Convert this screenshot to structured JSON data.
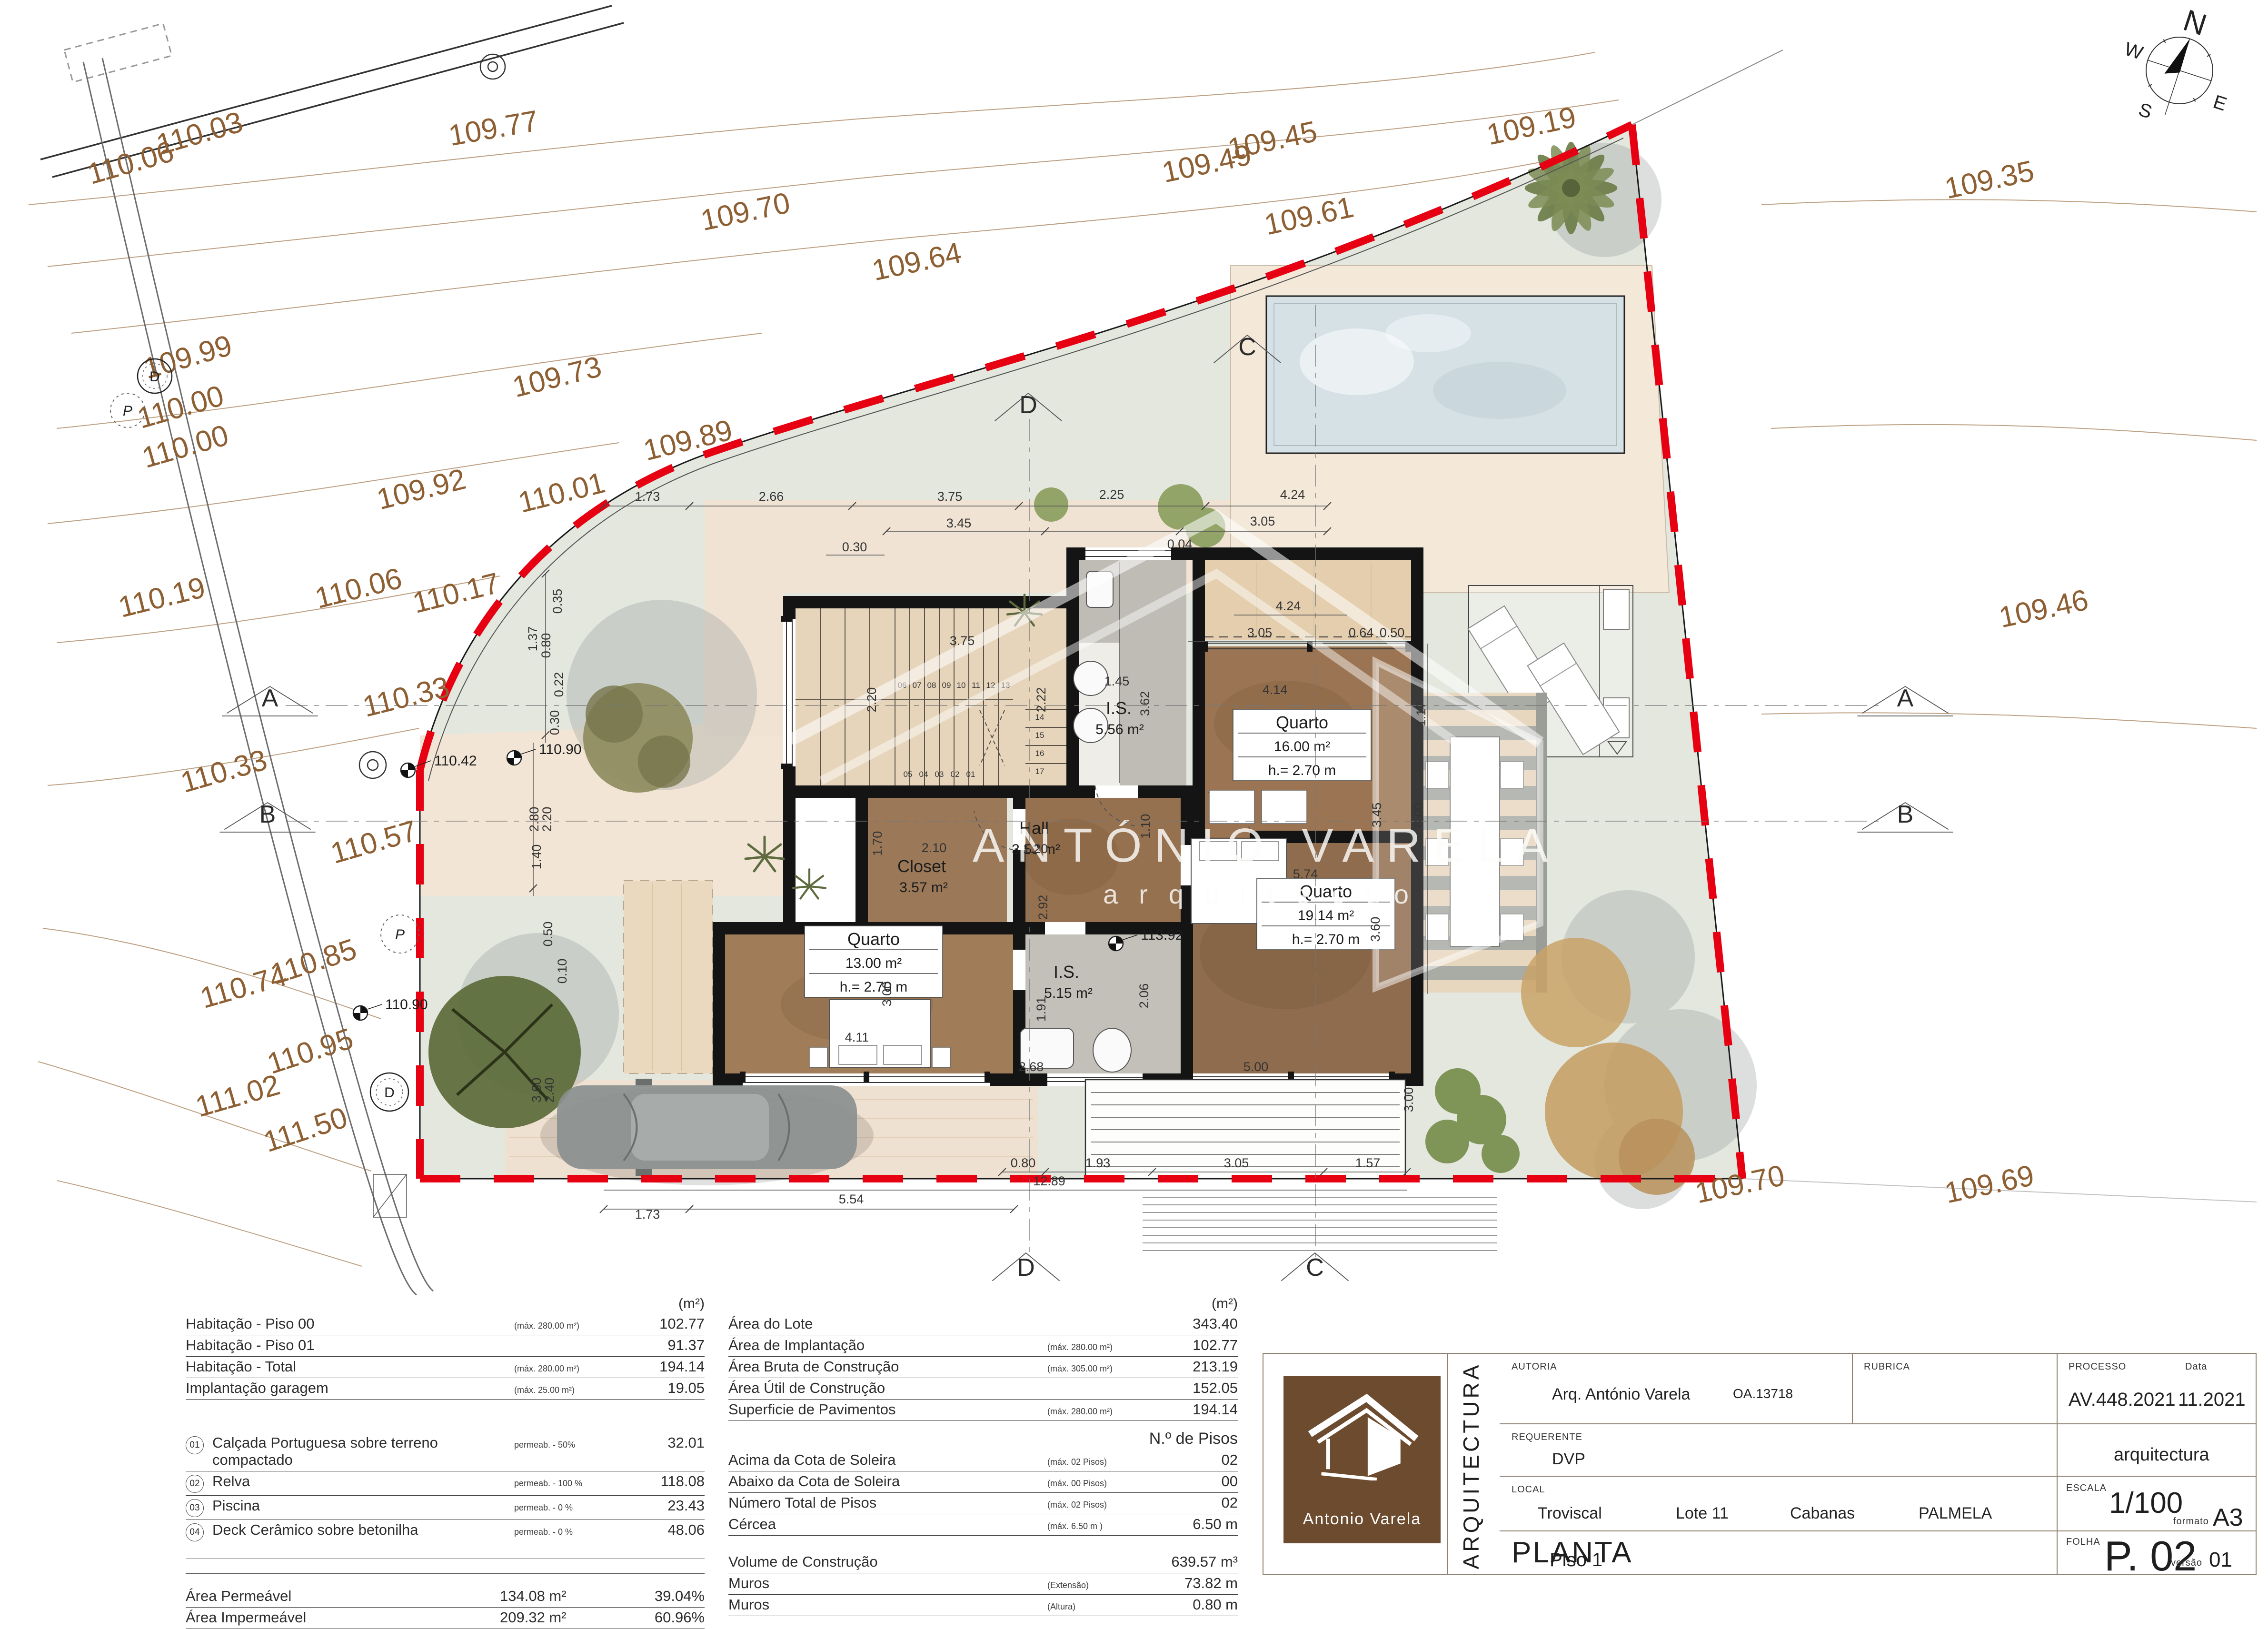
{
  "compass": {
    "n": "N",
    "e": "E",
    "s": "S",
    "w": "W"
  },
  "watermark": {
    "line1": "ANTÓNIO VARELA",
    "line2": "arquitecto"
  },
  "plan": {
    "contours": [
      "110.03",
      "110.06",
      "109.77",
      "109.70",
      "109.64",
      "109.73",
      "109.99",
      "110.00",
      "110.00",
      "109.92",
      "110.01",
      "109.89",
      "110.06",
      "110.17",
      "110.19",
      "110.33",
      "110.33",
      "110.57",
      "110.85",
      "110.74",
      "110.95",
      "111.02",
      "111.50",
      "109.49",
      "109.45",
      "109.61",
      "109.19",
      "109.35",
      "109.46",
      "109.70",
      "109.69"
    ],
    "dims": [
      "1.73",
      "2.66",
      "3.75",
      "2.25",
      "4.24",
      "3.45",
      "3.05",
      "0.30",
      "0.04",
      "4.24",
      "3.05",
      "0.64",
      "0.50",
      "1.17",
      "0.35",
      "1.37",
      "0.80",
      "0.22",
      "0.30",
      "2.80",
      "2.20",
      "3.75",
      "2.20",
      "2.22",
      "1.45",
      "3.62",
      "4.14",
      "3.45",
      "1.10",
      "5.74",
      "2.10",
      "1.70",
      "1.20",
      "2.92",
      "1.91",
      "2.06",
      "2.68",
      "5.00",
      "3.60",
      "3.00",
      "4.11",
      "0.50",
      "0.10",
      "1.40",
      "3.60",
      "2.40",
      "0.80",
      "1.93",
      "3.05",
      "1.57",
      "12.89",
      "5.54",
      "1.73",
      "8.00",
      "3.00"
    ],
    "stairs": [
      "01",
      "02",
      "03",
      "04",
      "05",
      "06",
      "07",
      "08",
      "09",
      "10",
      "11",
      "12",
      "13",
      "14",
      "15",
      "16",
      "17"
    ],
    "rooms": [
      {
        "name": "I.S.",
        "area": "5.56 m²",
        "h": ""
      },
      {
        "name": "Quarto",
        "area": "16.00 m²",
        "h": "h.= 2.70 m"
      },
      {
        "name": "Closet",
        "area": "3.57 m²",
        "h": ""
      },
      {
        "name": "Hall",
        "area": "3.53 m²",
        "h": ""
      },
      {
        "name": "Quarto",
        "area": "19.14 m²",
        "h": "h.= 2.70 m"
      },
      {
        "name": "Quarto",
        "area": "13.00 m²",
        "h": "h.= 2.70 m"
      },
      {
        "name": "I.S.",
        "area": "5.15 m²",
        "h": ""
      }
    ],
    "elevations": [
      "110.42",
      "110.90",
      "110.90",
      "113.92"
    ],
    "sections": {
      "a": "A",
      "b": "B",
      "c": "C",
      "d": "D"
    },
    "symbols": {
      "d": "D",
      "p": "P"
    }
  },
  "area_table": {
    "unit_header": "(m²)",
    "rows": [
      {
        "label": "Habitação - Piso 00",
        "note": "(máx. 280.00 m²)",
        "value": "102.77"
      },
      {
        "label": "Habitação - Piso 01",
        "note": "",
        "value": "91.37"
      },
      {
        "label": "Habitação - Total",
        "note": "(máx. 280.00 m²)",
        "value": "194.14"
      },
      {
        "label": "Implantação garagem",
        "note": "(máx.  25.00 m²)",
        "value": "19.05"
      }
    ],
    "materials": [
      {
        "num": "01",
        "label": "Calçada Portuguesa sobre terreno compactado",
        "note": "permeab. -  50%",
        "value": "32.01"
      },
      {
        "num": "02",
        "label": "Relva",
        "note": "permeab. - 100 %",
        "value": "118.08"
      },
      {
        "num": "03",
        "label": "Piscina",
        "note": "permeab. -   0 %",
        "value": "23.43"
      },
      {
        "num": "04",
        "label": "Deck Cerâmico sobre betonilha",
        "note": "permeab. -   0 %",
        "value": "48.06"
      }
    ],
    "totals": [
      {
        "label": "Área Permeável",
        "value": "134.08 m²",
        "pct": "39.04%"
      },
      {
        "label": "Área Impermeável",
        "value": "209.32 m²",
        "pct": "60.96%"
      }
    ]
  },
  "lot_table": {
    "unit_header": "(m²)",
    "rows": [
      {
        "label": "Área do Lote",
        "note": "",
        "value": "343.40"
      },
      {
        "label": "Área de Implantação",
        "note": "(máx. 280.00 m²)",
        "value": "102.77"
      },
      {
        "label": "Área Bruta de Construção",
        "note": "(máx. 305.00 m²)",
        "value": "213.19"
      },
      {
        "label": "Área Útil de Construção",
        "note": "",
        "value": "152.05"
      },
      {
        "label": "Superficie de Pavimentos",
        "note": "(máx. 280.00 m²)",
        "value": "194.14"
      }
    ],
    "floors_header": "N.º  de Pisos",
    "floors": [
      {
        "label": "Acima da Cota de Soleira",
        "note": "(máx. 02 Pisos)",
        "value": "02"
      },
      {
        "label": "Abaixo da Cota de Soleira",
        "note": "(máx. 00 Pisos)",
        "value": "00"
      },
      {
        "label": "Número Total de Pisos",
        "note": "(máx. 02 Pisos)",
        "value": "02"
      },
      {
        "label": "Cércea",
        "note": "(máx.   6.50  m )",
        "value": "6.50 m"
      }
    ],
    "extras": [
      {
        "label": "Volume de Construção",
        "note": "",
        "value": "639.57 m³"
      },
      {
        "label": "Muros",
        "note": "(Extensão)",
        "value": "73.82 m"
      },
      {
        "label": "Muros",
        "note": "(Altura)",
        "value": "0.80 m"
      }
    ]
  },
  "titleblock": {
    "logo_name": "Antonio  Varela",
    "discipline": "ARQUITECTURA",
    "autoria_label": "AUTORIA",
    "autoria": "Arq. António Varela",
    "autoria_reg": "OA.13718",
    "rubrica_label": "RUBRICA",
    "processo_label": "PROCESSO",
    "processo": "AV.448.2021",
    "data_label": "Data",
    "data": "11.2021",
    "requerente_label": "REQUERENTE",
    "requerente": "DVP",
    "discipline_small": "arquitectura",
    "local_label": "LOCAL",
    "local_1": "Troviscal",
    "local_2": "Lote 11",
    "local_3": "Cabanas",
    "local_4": "PALMELA",
    "escala_label": "ESCALA",
    "escala": "1/100",
    "formato_label": "formato",
    "formato": "A3",
    "drawing_title": "PLANTA",
    "drawing_subtitle": "Piso 1",
    "folha_label": "FOLHA",
    "folha": "P. 02",
    "versao_label": "versão",
    "versao": "01"
  }
}
